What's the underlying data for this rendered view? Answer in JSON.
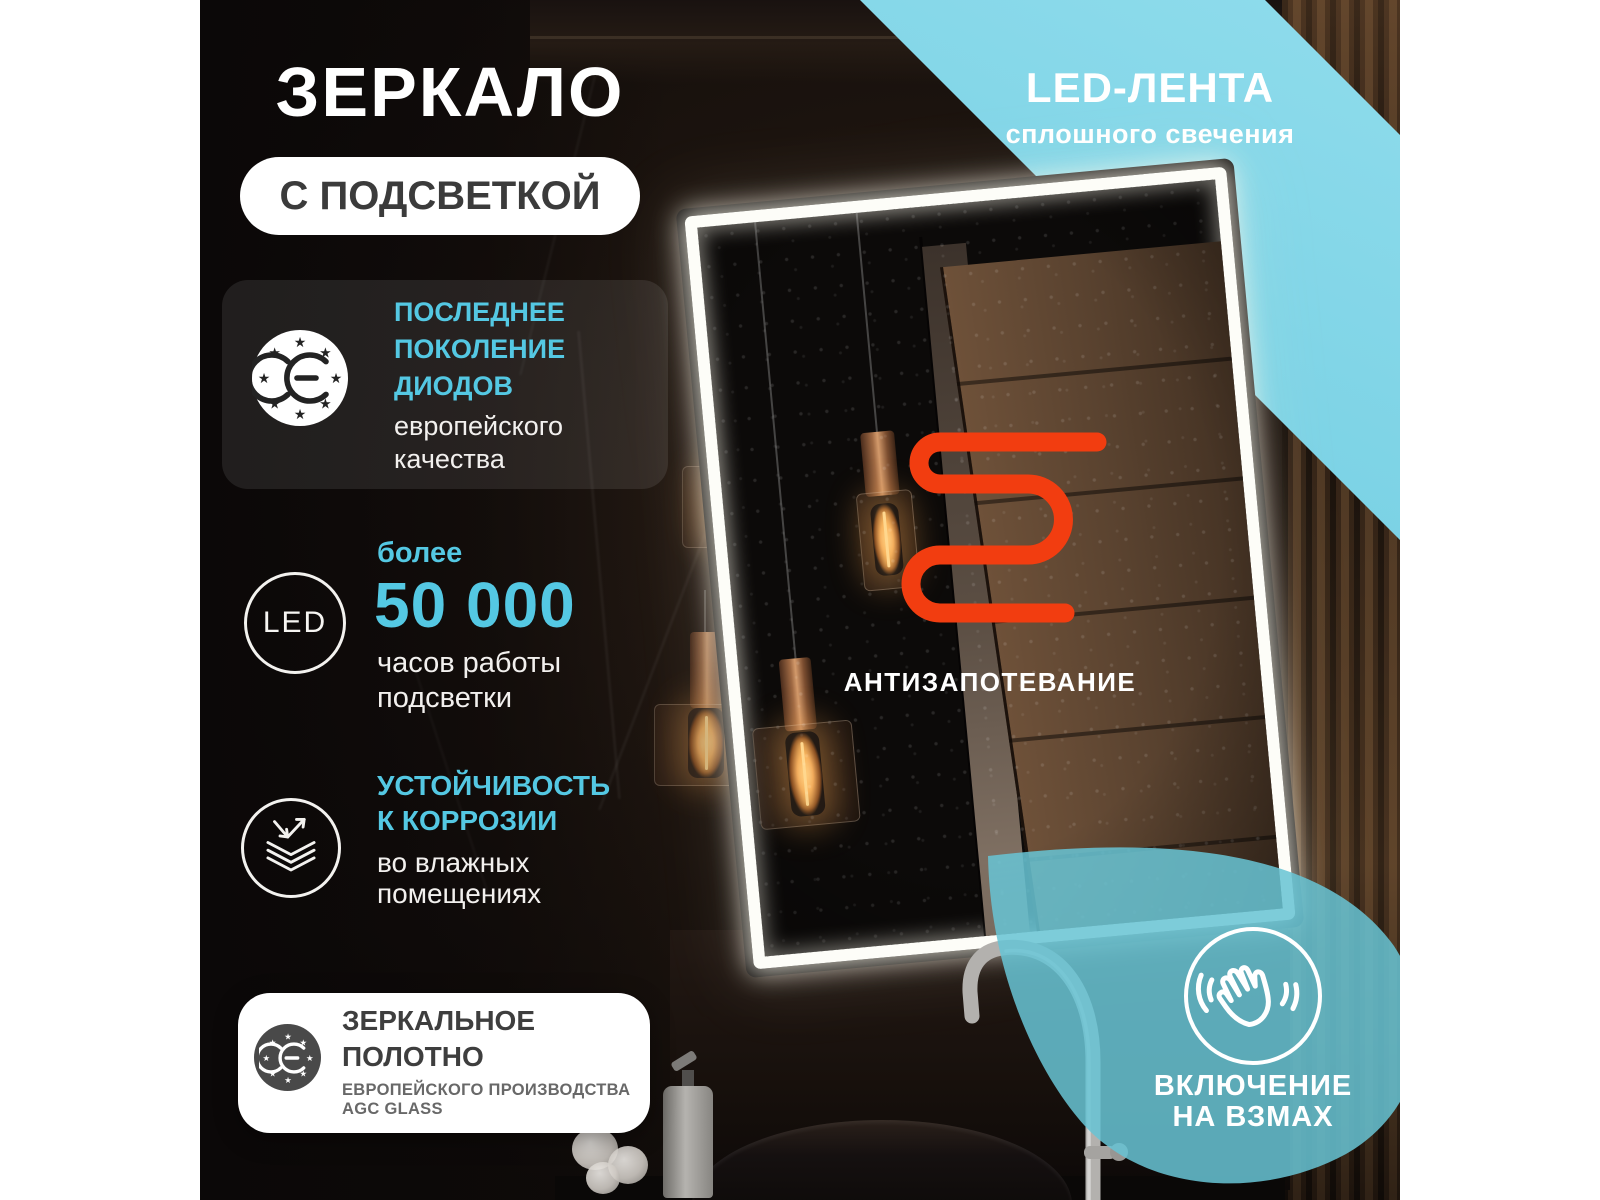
{
  "page": {
    "title_main": "ЗЕРКАЛО",
    "title_badge": "С ПОДСВЕТКОЙ"
  },
  "banner": {
    "title": "LED-ЛЕНТА",
    "subtitle": "сплошного свечения",
    "color": "#79d1e4"
  },
  "features": [
    {
      "icon": "ce-stars-icon",
      "title_lines": [
        "ПОСЛЕДНЕЕ",
        "ПОКОЛЕНИЕ",
        "ДИОДОВ"
      ],
      "subtitle_lines": [
        "европейского",
        "качества"
      ]
    },
    {
      "icon": "led-ring-icon",
      "badge": "LED",
      "intro": "более",
      "value": "50 000",
      "subtitle_lines": [
        "часов работы",
        "подсветки"
      ]
    },
    {
      "icon": "corrosion-layers-icon",
      "title_lines": [
        "УСТОЙЧИВОСТЬ",
        "К КОРРОЗИИ"
      ],
      "subtitle_lines": [
        "во влажных",
        "помещениях"
      ]
    }
  ],
  "glass_card": {
    "icon": "ce-stars-icon",
    "title_lines": [
      "ЗЕРКАЛЬНОЕ",
      "ПОЛОТНО"
    ],
    "subtitle_lines": [
      "ЕВРОПЕЙСКОГО ПРОИЗВОДСТВА",
      "AGC GLASS"
    ]
  },
  "mirror": {
    "antifog_label": "АНТИЗАПОТЕВАНИЕ",
    "heater_color": "#f23d10"
  },
  "gesture": {
    "icon": "waving-hand-icon",
    "line1": "ВКЛЮЧЕНИЕ",
    "line2": "НА ВЗМАХ"
  },
  "colors": {
    "accent_blue": "#54c8e3",
    "banner_blue": "#79d1e4",
    "drop_teal": "#68c4d4",
    "orange": "#f23d10",
    "margin": "#ffffff"
  }
}
